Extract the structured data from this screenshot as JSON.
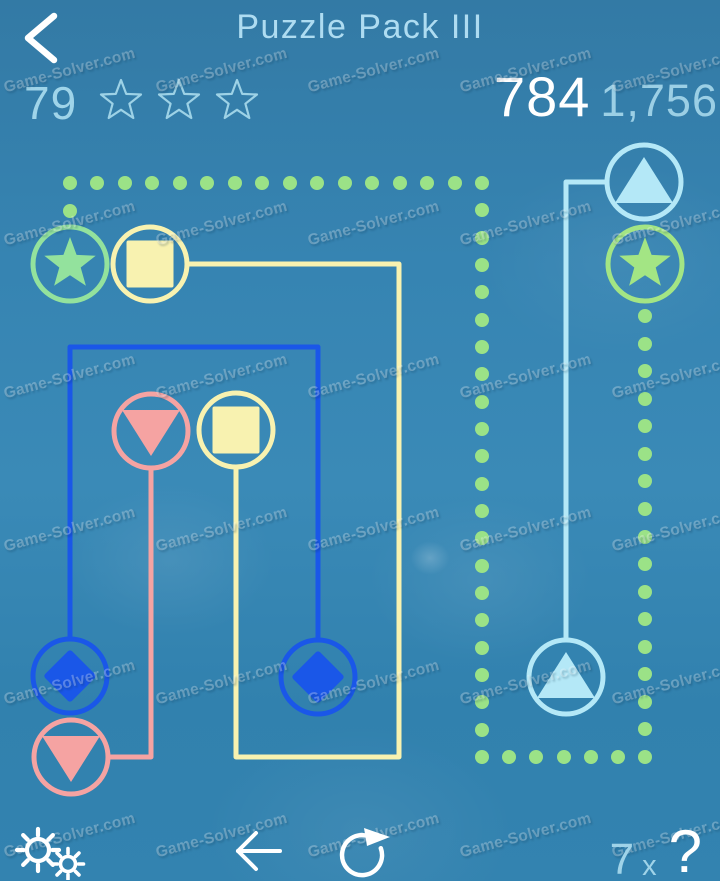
{
  "header": {
    "title": "Puzzle Pack III",
    "level": "79",
    "stars_total": 3,
    "stars_earned": 0,
    "score": "784",
    "best_score": "1,756"
  },
  "watermark": {
    "text": "Game-Solver.com"
  },
  "footer": {
    "hint_count": "7",
    "hint_times": "x",
    "hint_question": "?"
  },
  "colors": {
    "green": "#9be38f",
    "yellow": "#f8f2b0",
    "pink": "#f5a3a2",
    "blue": "#1a57e8",
    "cyan": "#b4e8f7",
    "header_text": "#9fd4e9",
    "title_text": "#aedcf1",
    "score_text": "#ffffff"
  },
  "board": {
    "circle_radius": 37,
    "stroke_width": 5,
    "pieces": [
      {
        "name": "green-star-top-left",
        "x": 70,
        "y": 264,
        "shape": "star",
        "color": "#93e29d"
      },
      {
        "name": "yellow-square-top",
        "x": 150,
        "y": 264,
        "shape": "square",
        "color": "#f8f2b0"
      },
      {
        "name": "cyan-triangle-top-right",
        "x": 644,
        "y": 182,
        "shape": "triangle-up",
        "color": "#b4e8f7"
      },
      {
        "name": "green-star-right",
        "x": 645,
        "y": 264,
        "shape": "star",
        "color": "#a3e584"
      },
      {
        "name": "pink-triangle-middle",
        "x": 151,
        "y": 431,
        "shape": "triangle-down",
        "color": "#f5a3a2"
      },
      {
        "name": "yellow-square-middle",
        "x": 236,
        "y": 430,
        "shape": "square",
        "color": "#f8f2b0"
      },
      {
        "name": "blue-diamond-left",
        "x": 70,
        "y": 676,
        "shape": "diamond",
        "color": "#1a57e8"
      },
      {
        "name": "pink-triangle-bottom-left",
        "x": 71,
        "y": 757,
        "shape": "triangle-down",
        "color": "#f5a3a2"
      },
      {
        "name": "blue-diamond-middle",
        "x": 318,
        "y": 677,
        "shape": "diamond",
        "color": "#1a57e8"
      },
      {
        "name": "cyan-triangle-bottom-right",
        "x": 566,
        "y": 677,
        "shape": "triangle-up",
        "color": "#b4e8f7"
      }
    ],
    "paths": [
      {
        "name": "blue-path",
        "color": "#1a57e8",
        "points": [
          [
            70,
            639
          ],
          [
            70,
            347
          ],
          [
            318,
            347
          ],
          [
            318,
            640
          ]
        ]
      },
      {
        "name": "pink-path",
        "color": "#f5a3a2",
        "points": [
          [
            108,
            757
          ],
          [
            151,
            757
          ],
          [
            151,
            468
          ]
        ]
      },
      {
        "name": "yellow-path",
        "color": "#f8f2b0",
        "points": [
          [
            187,
            264
          ],
          [
            399,
            264
          ],
          [
            399,
            757
          ],
          [
            236,
            757
          ],
          [
            236,
            467
          ]
        ]
      },
      {
        "name": "cyan-path",
        "color": "#b4e8f7",
        "points": [
          [
            607,
            182
          ],
          [
            566,
            182
          ],
          [
            566,
            640
          ]
        ]
      }
    ],
    "dotted_path": {
      "name": "green-dotted-path",
      "color": "#9be287",
      "dot_radius": 7,
      "spacing": 27.4,
      "points": [
        [
          70,
          211
        ],
        [
          70,
          183
        ],
        [
          482,
          183
        ],
        [
          482,
          757
        ],
        [
          645,
          757
        ],
        [
          645,
          316
        ]
      ]
    }
  }
}
